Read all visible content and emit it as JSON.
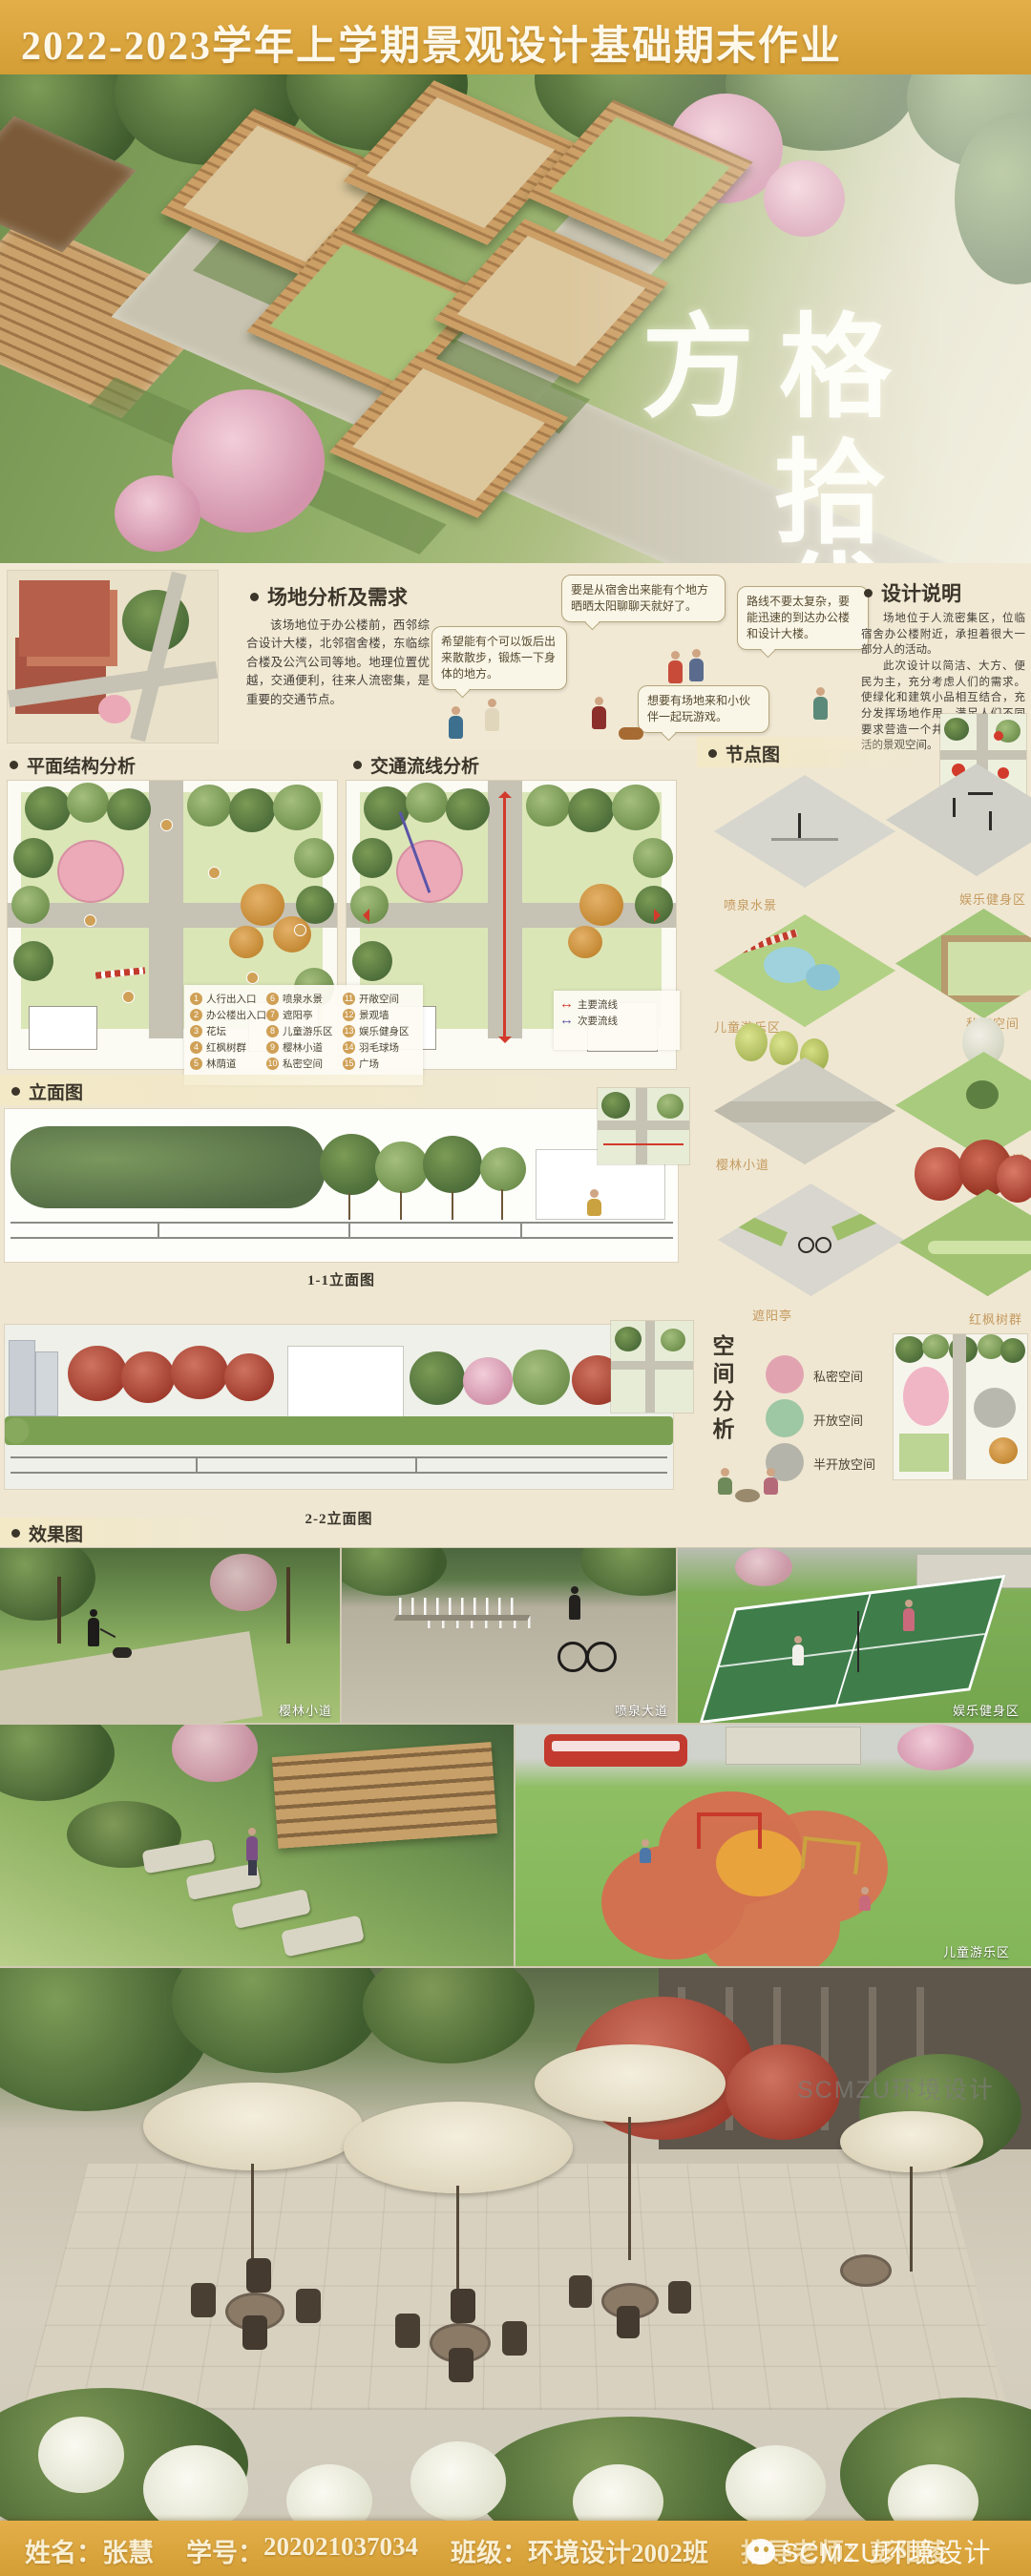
{
  "header": {
    "title": "2022-2023学年上学期景观设计基础期末作业"
  },
  "hero": {
    "title_word_1": "方格",
    "title_word_2": "拾代"
  },
  "site_analysis": {
    "heading": "场地分析及需求",
    "body": "该场地位于办公楼前，西邻综合设计大楼，北邻宿舍楼，东临综合楼及公汽公司等地。地理位置优越，交通便利，往来人流密集，是重要的交通节点。",
    "bubbles": [
      {
        "text": "希望能有个可以饭后出来散散步，锻炼一下身体的地方。"
      },
      {
        "text": "要是从宿舍出来能有个地方晒晒太阳聊聊天就好了。"
      },
      {
        "text": "路线不要太复杂，要能迅速的到达办公楼和设计大楼。"
      },
      {
        "text": "想要有场地来和小伙伴一起玩游戏。"
      }
    ]
  },
  "design_notes": {
    "heading": "设计说明",
    "para1": "场地位于人流密集区，位临宿舍办公楼附近，承担着很大一部分人的活动。",
    "para2": "此次设计以简洁、大方、便民为主，充分考虑人们的需求。使绿化和建筑小品相互结合，充分发挥场地作用，满足人们不同要求营造一个井然有序，健康乐活的景观空间。"
  },
  "plan_structure": {
    "heading": "平面结构分析",
    "legend": [
      {
        "num": "1",
        "label": "人行出入口"
      },
      {
        "num": "2",
        "label": "办公楼出入口"
      },
      {
        "num": "3",
        "label": "花坛"
      },
      {
        "num": "4",
        "label": "红枫树群"
      },
      {
        "num": "5",
        "label": "林荫道"
      },
      {
        "num": "6",
        "label": "喷泉水景"
      },
      {
        "num": "7",
        "label": "遮阳亭"
      },
      {
        "num": "8",
        "label": "儿童游乐区"
      },
      {
        "num": "9",
        "label": "樱林小道"
      },
      {
        "num": "10",
        "label": "私密空间"
      },
      {
        "num": "11",
        "label": "开敞空间"
      },
      {
        "num": "12",
        "label": "景观墙"
      },
      {
        "num": "13",
        "label": "娱乐健身区"
      },
      {
        "num": "14",
        "label": "羽毛球场"
      },
      {
        "num": "15",
        "label": "广场"
      }
    ]
  },
  "circulation": {
    "heading": "交通流线分析",
    "legend": [
      {
        "label": "主要流线",
        "color": "#d23a2b"
      },
      {
        "label": "次要流线",
        "color": "#5a55a8"
      }
    ]
  },
  "nodes": {
    "heading": "节点图",
    "captions": [
      {
        "text": "喷泉水景"
      },
      {
        "text": "娱乐健身区"
      },
      {
        "text": "儿童游乐区"
      },
      {
        "text": "私密空间"
      },
      {
        "text": "樱林小道"
      },
      {
        "text": "开敞空间"
      },
      {
        "text": "遮阳亭"
      },
      {
        "text": "红枫树群"
      }
    ]
  },
  "elevations": {
    "heading": "立面图",
    "label_1": "1-1立面图",
    "label_2": "2-2立面图"
  },
  "space_analysis": {
    "heading": "空间分析",
    "legend": [
      {
        "label": "私密空间",
        "color": "#e2a3b1"
      },
      {
        "label": "开放空间",
        "color": "#9ec7a4"
      },
      {
        "label": "半开放空间",
        "color": "#b5b4aa"
      }
    ]
  },
  "renders": {
    "heading": "效果图",
    "caption_1": "樱林小道",
    "caption_2": "喷泉大道",
    "caption_3": "娱乐健身区",
    "caption_4": "儿童游乐区",
    "watermark": "SCMZU环境设计"
  },
  "footer": {
    "name_label": "姓名：",
    "name": "张慧",
    "id_label": "学号：",
    "student_id": "202021037034",
    "class_label": "班级：",
    "class_name": "环境设计2002班",
    "advisor_label": "指导老师：",
    "advisor": "彭阳陵",
    "watermark": "SCMZU环境设计"
  },
  "colors": {
    "banner_gold": "#d9a440",
    "cream_bg": "#f1e9d4",
    "caption_tan": "#c59a5f",
    "accent_red": "#d23a2b"
  }
}
